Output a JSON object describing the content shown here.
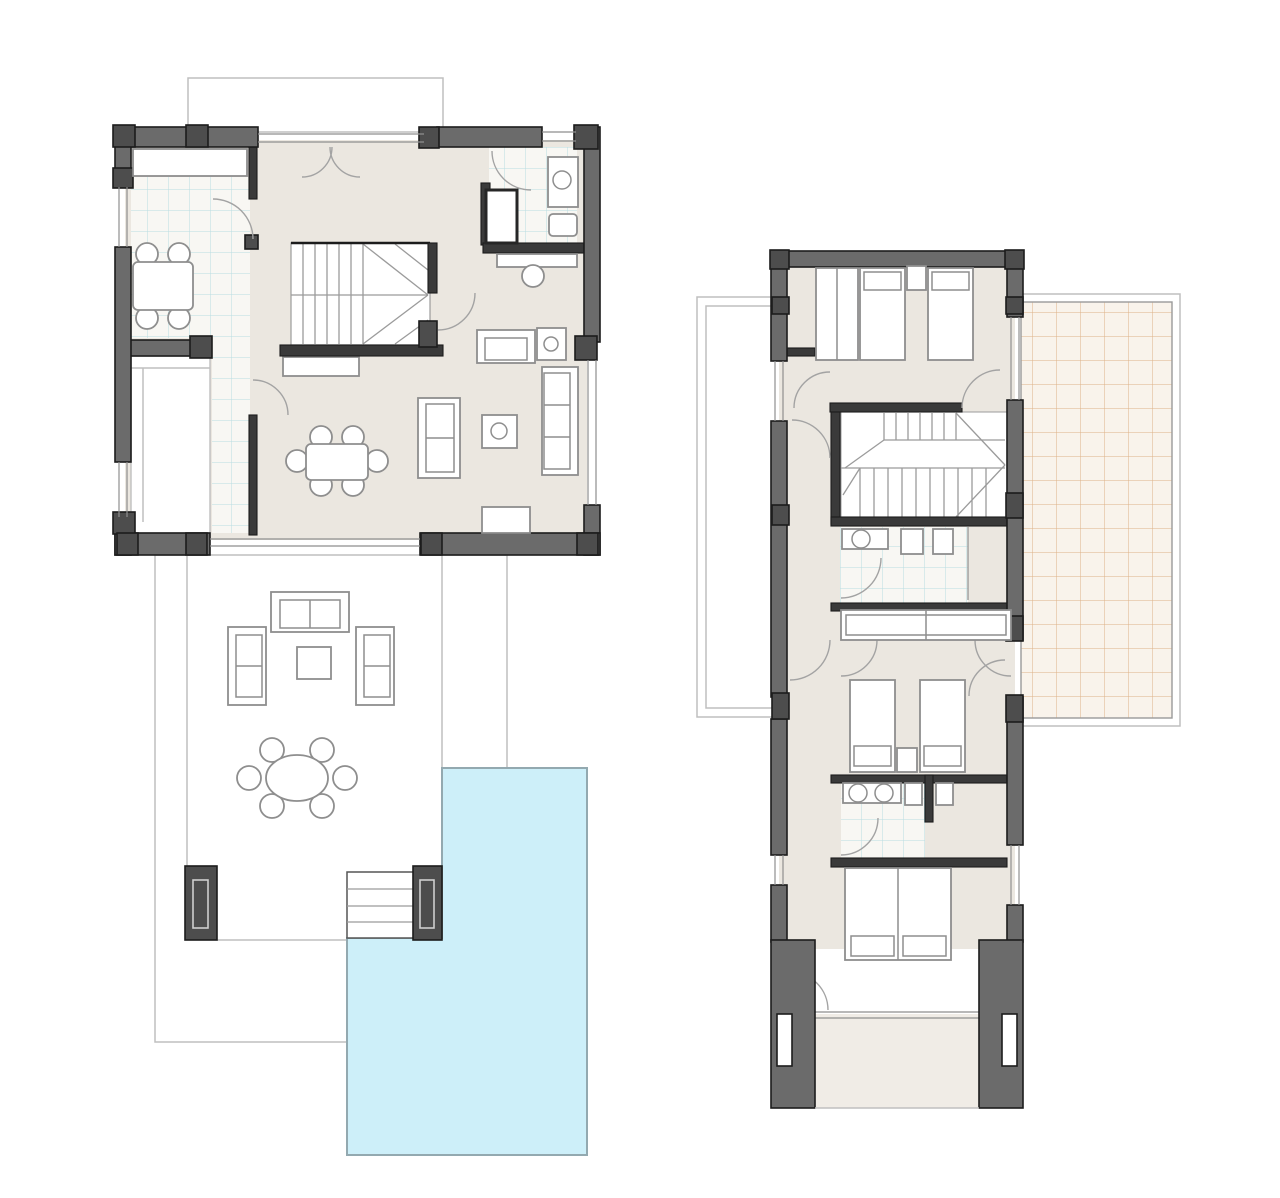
{
  "canvas": {
    "width": 1280,
    "height": 1198,
    "background": "#ffffff"
  },
  "colors": {
    "wall_fill": "#6b6b6b",
    "wall_dark": "#3a3a3a",
    "block_fill": "#4d4d4d",
    "wall_stroke": "#1c1c1c",
    "floor": "#ebe7e0",
    "floor_light": "#f0ece6",
    "porch": "#ffffff",
    "terrace_bg": "#f9f3eb",
    "terrace_grid": "#ddb287",
    "terrace_grid_light": "#e4c9a8",
    "wet_bg": "#f8f7f3",
    "wet_grid": "#b9dce2",
    "pool_fill": "#cdeff9",
    "pool_stroke": "#93a9b0",
    "furniture_fill": "#ffffff",
    "furniture_stroke": "#8e8e8e",
    "door_arc": "#a3a3a3",
    "stair_line": "#9b9b9b",
    "thin_outline": "#bfbfbf",
    "window_line": "#8e8e8e",
    "background": "#ffffff"
  },
  "plans": [
    {
      "id": "ground-floor",
      "position": "left",
      "rooms": [
        "kitchen",
        "hallway",
        "entry-porch",
        "staircase",
        "bathroom",
        "living-dining-room"
      ],
      "outdoor": [
        "upper-terrace-strip",
        "main-terrace",
        "pool-steps",
        "swimming-pool",
        "terrace-pillars"
      ],
      "furniture": [
        "kitchen-counter",
        "kitchen-table-with-4-chairs",
        "dining-table-with-6-chairs",
        "sofa-set",
        "coffee-table",
        "side-tables",
        "tv-bench",
        "shower",
        "washbasin",
        "toilet",
        "vanity",
        "outdoor-lounge-set",
        "outdoor-round-table-with-6-chairs"
      ]
    },
    {
      "id": "first-floor",
      "position": "right",
      "rooms": [
        "bedroom-1",
        "hallway",
        "staircase",
        "bathroom-1",
        "closet",
        "bedroom-2",
        "bathroom-2",
        "bedroom-3",
        "balcony"
      ],
      "outdoor": [
        "roof-terrace",
        "ground-floor-roof-outline"
      ],
      "furniture": [
        "wardrobe",
        "single-beds",
        "nightstands",
        "washbasins",
        "toilets",
        "double-bed"
      ]
    }
  ]
}
